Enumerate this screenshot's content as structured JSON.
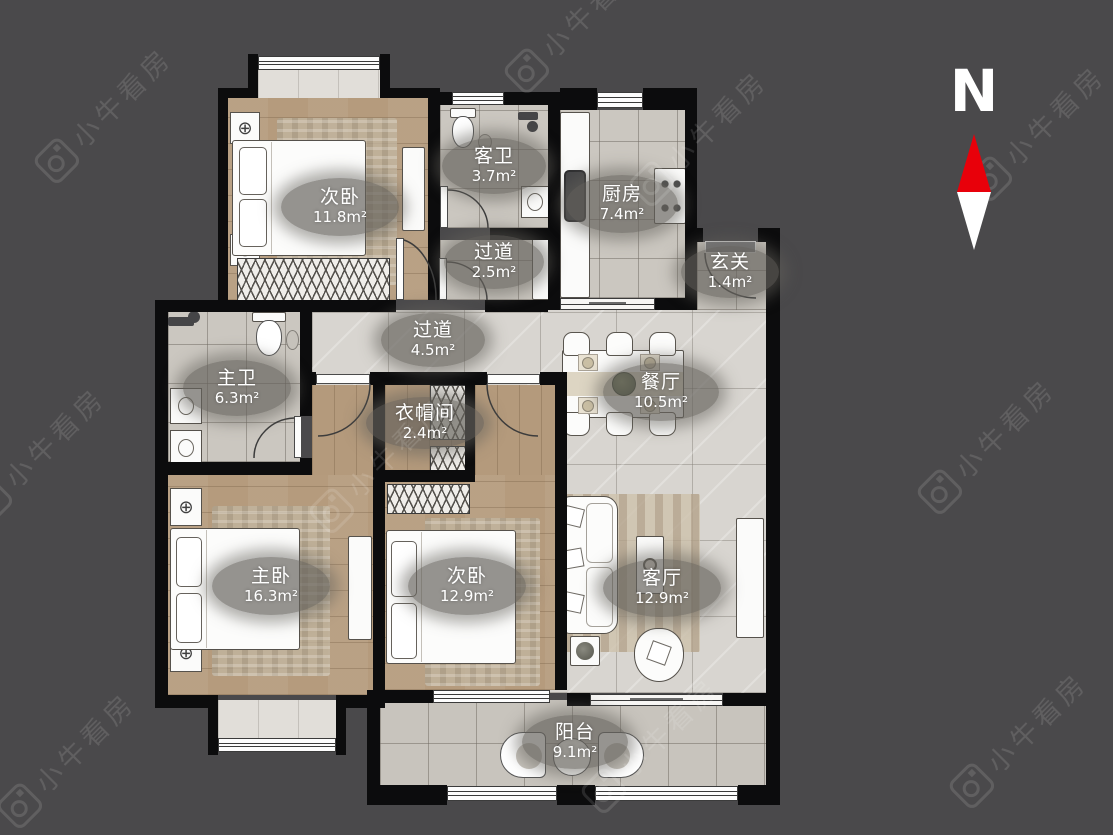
{
  "watermark": {
    "text": "小牛看房"
  },
  "compass": {
    "label": "N"
  },
  "icons": {
    "ceiling_light": "⊕"
  },
  "rooms": [
    {
      "name": "次卧",
      "area": "11.8m²"
    },
    {
      "name": "客卫",
      "area": "3.7m²"
    },
    {
      "name": "厨房",
      "area": "7.4m²"
    },
    {
      "name": "玄关",
      "area": "1.4m²"
    },
    {
      "name": "过道",
      "area": "2.5m²"
    },
    {
      "name": "过道",
      "area": "4.5m²"
    },
    {
      "name": "主卫",
      "area": "6.3m²"
    },
    {
      "name": "衣帽间",
      "area": "2.4m²"
    },
    {
      "name": "餐厅",
      "area": "10.5m²"
    },
    {
      "name": "主卧",
      "area": "16.3m²"
    },
    {
      "name": "次卧",
      "area": "12.9m²"
    },
    {
      "name": "客厅",
      "area": "12.9m²"
    },
    {
      "name": "阳台",
      "area": "9.1m²"
    }
  ]
}
